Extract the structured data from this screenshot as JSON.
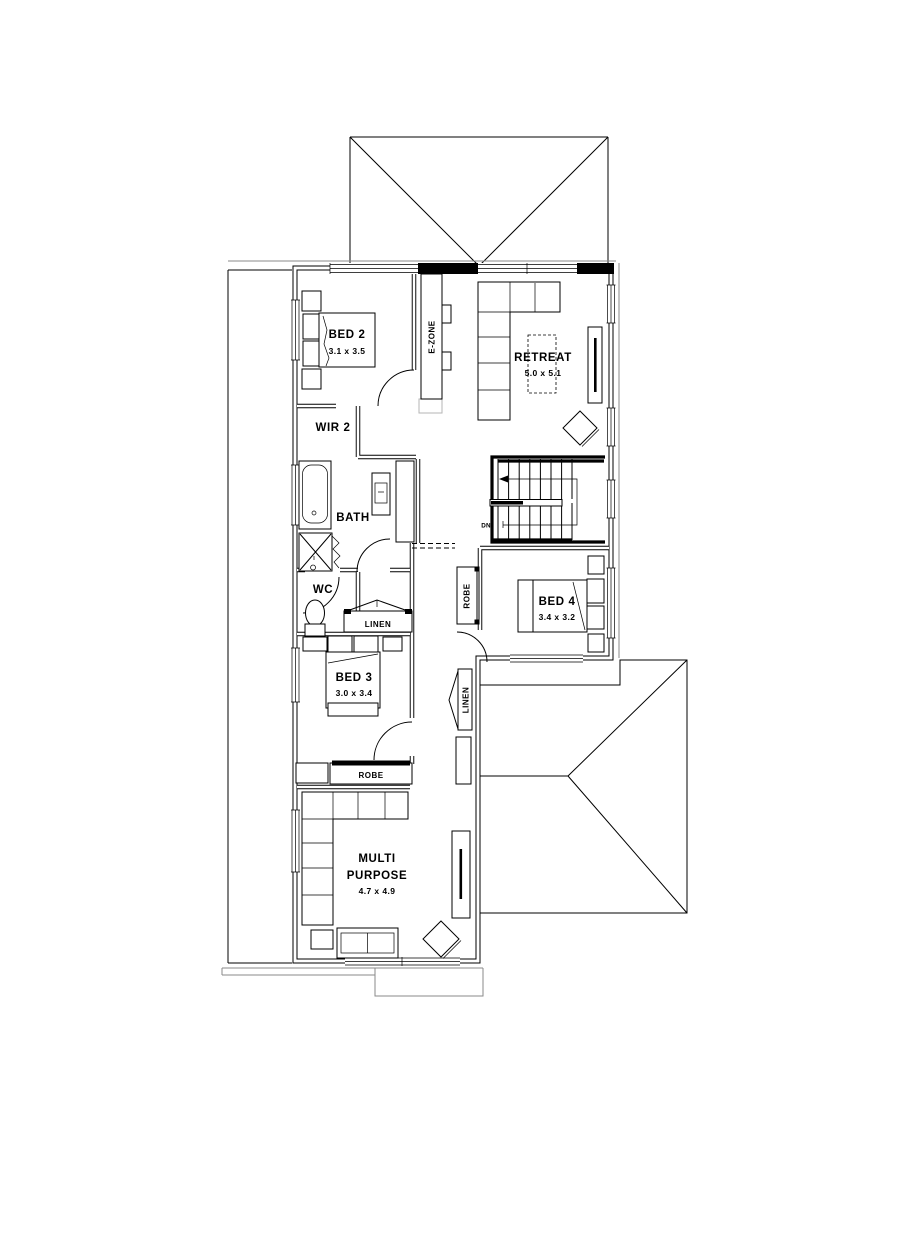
{
  "plan": {
    "rooms": {
      "bed2": {
        "name": "BED 2",
        "dims": "3.1 x 3.5"
      },
      "wir2": {
        "name": "WIR 2"
      },
      "ezone": {
        "name": "E-ZONE"
      },
      "retreat": {
        "name": "RETREAT",
        "dims": "5.0 x 5.1"
      },
      "bath": {
        "name": "BATH"
      },
      "wc": {
        "name": "WC"
      },
      "linen_hall": {
        "name": "LINEN"
      },
      "bed3": {
        "name": "BED 3",
        "dims": "3.0 x 3.4"
      },
      "robe_bed3": {
        "name": "ROBE"
      },
      "multipurpose": {
        "name_line1": "MULTI",
        "name_line2": "PURPOSE",
        "dims": "4.7 x 4.9"
      },
      "bed4": {
        "name": "BED 4",
        "dims": "3.4 x 3.2"
      },
      "robe_bed4": {
        "name": "ROBE"
      },
      "linen_upper": {
        "name": "LINEN"
      },
      "stairs": {
        "direction": "DN"
      }
    },
    "colors": {
      "background": "#ffffff",
      "line": "#000000",
      "eave_gray": "#8a8a8a"
    }
  }
}
